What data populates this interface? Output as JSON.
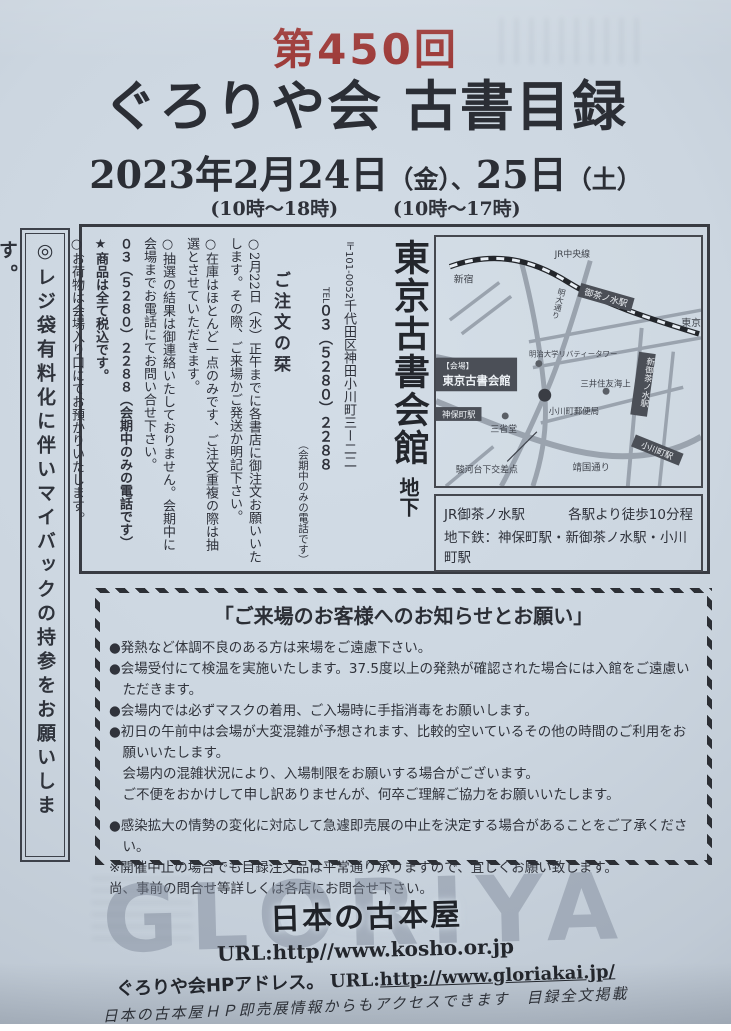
{
  "header": {
    "edition": "第450回",
    "title": "ぐろりや会 古書目録",
    "date_main1": "2023年2月24日",
    "date_paren1": "（金）、",
    "date_main2": "25日",
    "date_paren2": "（土）",
    "time_fri": "(10時〜18時)",
    "time_sat": "(10時〜17時)"
  },
  "left_banner": {
    "text": "◎レジ袋有料化に伴いマイバックの持参をお願いします。"
  },
  "order": {
    "heading": "ご注文の栞",
    "note1": "○2月22日（水）正午までに各書店に御注文お願いいたします。その際、ご来場かご発送か明記下さい。",
    "note2": "○在庫はほとんど一点のみです、ご注文重複の際は抽選とさせていただきます。",
    "note3": "○抽選の結果は御連絡いたしておりません。会期中に会場までお電話にてお問い合せ下さい。",
    "note3_phone": "０３（５２８０）２２８８（会期中のみの電話です）",
    "note4": "★商品は全て税込です。",
    "note5": "○お荷物は会場入り口にてお預かりいたします。"
  },
  "venue": {
    "postal": "〒101-0052",
    "address": "千代田区神田小川町三ー二二",
    "tel_label": "TEL",
    "tel": "０３（５２８０）２２８８",
    "tel_note": "（会期中のみの電話です）",
    "name": "東京古書会館",
    "floor": "地下",
    "access1_left": "JR御茶ノ水駅",
    "access1_right": "各駅より徒歩10分程",
    "access2": "地下鉄：神保町駅・新御茶ノ水駅・小川町駅"
  },
  "map": {
    "labels": {
      "shinjuku": "新宿",
      "jr_chuo": "JR中央線",
      "tokyo": "東京",
      "ochanomizu": "御茶ノ水駅",
      "shin_ochanomizu": "新御茶ノ水駅",
      "meidai_dori": "明大通り",
      "meiji_univ": "明治大学リバティータワー",
      "mitsui": "三井住友海上",
      "ogawamachi_po": "小川町郵便局",
      "sanseido": "三省堂",
      "jimbocho": "神保町駅",
      "ogawamachi": "小川町駅",
      "surugadai": "駿河台下交差点",
      "yasukuni": "靖国通り",
      "venue_tag": "【会場】",
      "venue_name": "東京古書会館"
    }
  },
  "notice": {
    "title": "「ご来場のお客様へのお知らせとお願い」",
    "lines": [
      "●発熱など体調不良のある方は来場をご遠慮下さい。",
      "●会場受付にて検温を実施いたします。37.5度以上の発熱が確認された場合には入館をご遠慮いただきます。",
      "●会場内では必ずマスクの着用、ご入場時に手指消毒をお願いします。",
      "●初日の午前中は会場が大変混雑が予想されます、比較的空いているその他の時間のご利用をお願いいたします。",
      "会場内の混雑状況により、入場制限をお願いする場合がございます。",
      "ご不便をおかけして申し訳ありませんが、何卒ご理解ご協力をお願いいたします。",
      "●感染拡大の情勢の変化に対応して急遽即売展の中止を決定する場合があることをご了承ください。",
      "※開催中止の場合でも目録注文品は平常通り承りますので、宜しくお願い致します。",
      "尚、事前の問合せ等詳しくは各店にお問合せ下さい。"
    ]
  },
  "footer": {
    "watermark": "GLORIYA",
    "brand": "日本の古本屋",
    "url1": "URL:http//www.kosho.or.jp",
    "hp_label": "ぐろりや会HPアドレス。",
    "url2_prefix": "URL:",
    "url2": "http://www.gloriakai.jp/",
    "note": "日本の古本屋ＨＰ即売展情報からもアクセスできます　目録全文掲載"
  },
  "colors": {
    "edition_red": "#9e3c3a",
    "ink": "#2d3038",
    "map_box_dark": "#4b4f57",
    "street_gray": "#9aa3ae",
    "paper": "#ccd6e0"
  }
}
